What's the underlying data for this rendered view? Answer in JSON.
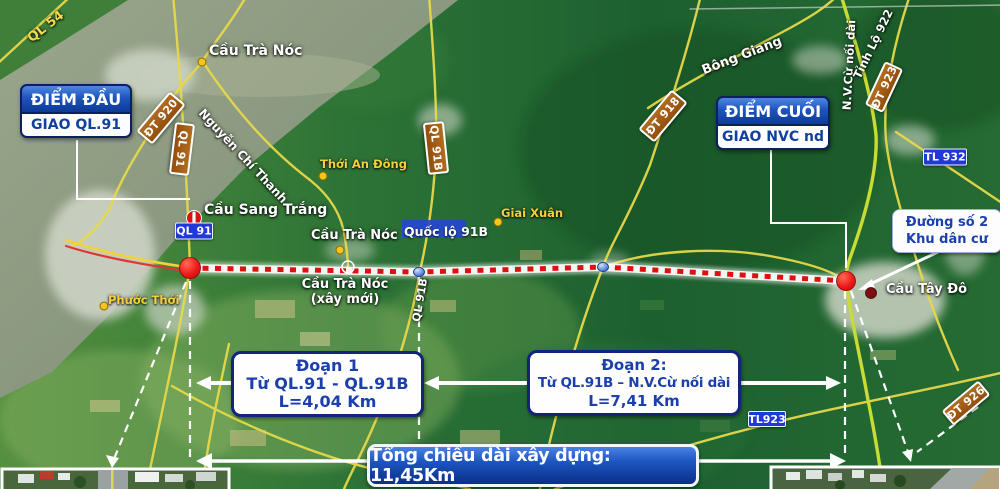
{
  "annotations": {
    "start_box": {
      "title": "ĐIỂM ĐẦU",
      "subtitle": "GIAO QL.91"
    },
    "end_box": {
      "title": "ĐIỂM CUỐI",
      "subtitle": "GIAO NVC nd"
    },
    "section1": {
      "name": "Đoạn 1",
      "route": "Từ QL.91 - QL.91B",
      "length": "L=4,04 Km"
    },
    "section2": {
      "name": "Đoạn 2:",
      "route": "Từ QL.91B – N.V.Cừ nối dài",
      "length": "L=7,41 Km"
    },
    "total_length": "Tổng chiều dài xây dựng: 11,45Km",
    "residential_label": {
      "line1": "Đường số 2",
      "line2": "Khu dân cư"
    }
  },
  "road_badges": {
    "dt920": "ĐT 920",
    "ql91": "QL 91",
    "ql91b": "QL 91B",
    "dt918": "ĐT 918",
    "dt923": "ĐT 923",
    "dt926": "ĐT 926",
    "ql91_blue": "QL 91",
    "tl932": "TL 932",
    "tl923": "TL923"
  },
  "road_names": {
    "ql54": "QL 54",
    "nguyen_chi_thanh": "Nguyễn Chí Thanh",
    "bong_giang": "Bông Giang",
    "nvc_noi_dai": "N.V.Cừ nối dài",
    "tinh_lo_922": "Tỉnh Lộ 922",
    "quoc_lo_91b": "Quốc lộ 91B",
    "ql91b_along": "QL 91B"
  },
  "places": {
    "cau_tra_noc_north": "Cầu Trà Nóc",
    "cau_sang_trang": "Cầu Sang Trắng",
    "thoi_an_dong": "Thới An Đông",
    "giai_xuan": "Giai Xuân",
    "cau_tra_noc": "Cầu Trà Nóc",
    "cau_tra_noc_new_line1": "Cầu Trà Nóc",
    "cau_tra_noc_new_line2": "(xây mới)",
    "phuoc_thoi": "Phước Thới",
    "cau_tay_do": "Cầu Tây Đô"
  },
  "credits": {
    "watermark": "Image © 2021 Maxar Technologies"
  },
  "colors": {
    "route_dotted": "#dd1111",
    "road_yellow": "#e6d84a",
    "road_new": "#c8dc35",
    "badge_brown": "#a35c14",
    "badge_blue": "#2138d8",
    "callout_blue": "#0c3a96",
    "text_blue": "#1c3fae"
  }
}
